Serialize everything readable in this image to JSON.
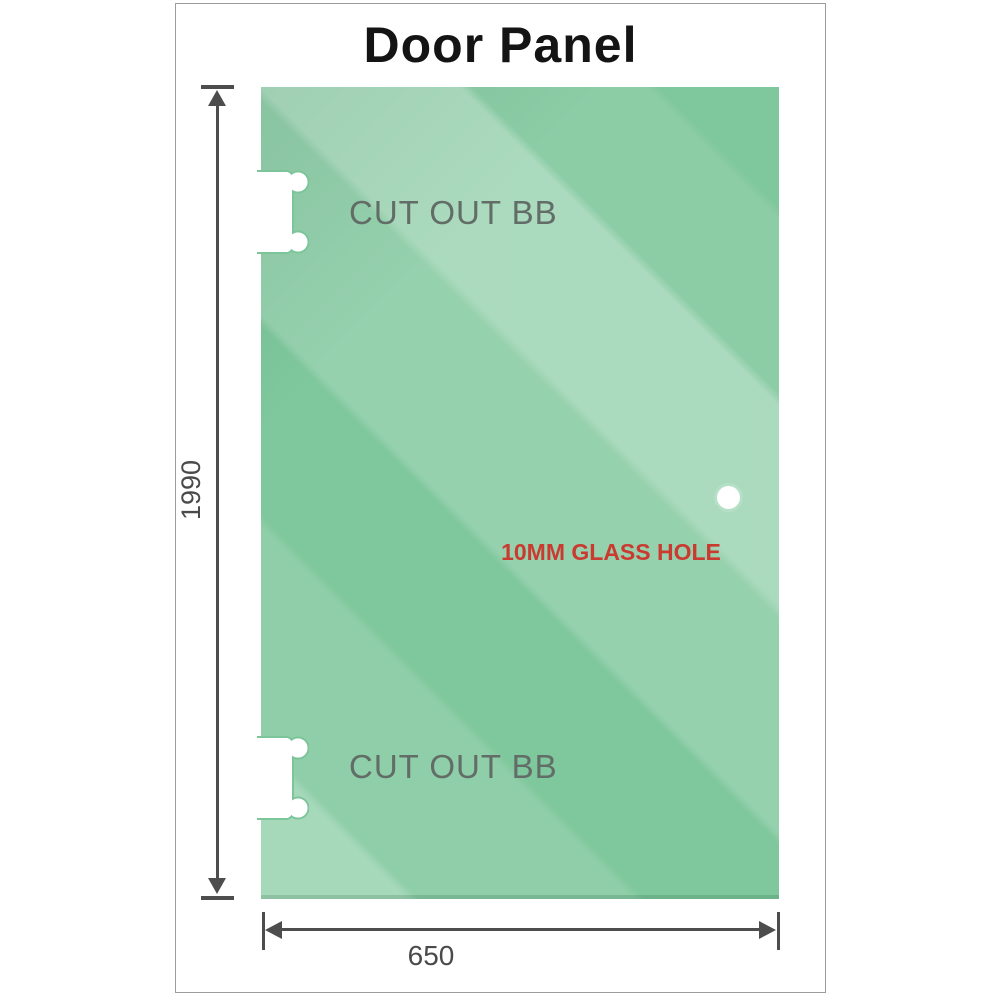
{
  "title": "Door Panel",
  "glass": {
    "cutouts": [
      {
        "label": "CUT OUT BB"
      },
      {
        "label": "CUT OUT BB"
      }
    ],
    "hole": {
      "label": "10MM GLASS HOLE"
    }
  },
  "dimensions": {
    "height": {
      "value": "1990"
    },
    "width": {
      "value": "650"
    }
  },
  "colors": {
    "glass_base": "#7fc79c",
    "dimension_line": "#4d4d4d",
    "cutout_text": "#616d66",
    "hole_label_text": "#cb3a30",
    "title_text": "#141414",
    "card_border": "#9c9c9c"
  }
}
